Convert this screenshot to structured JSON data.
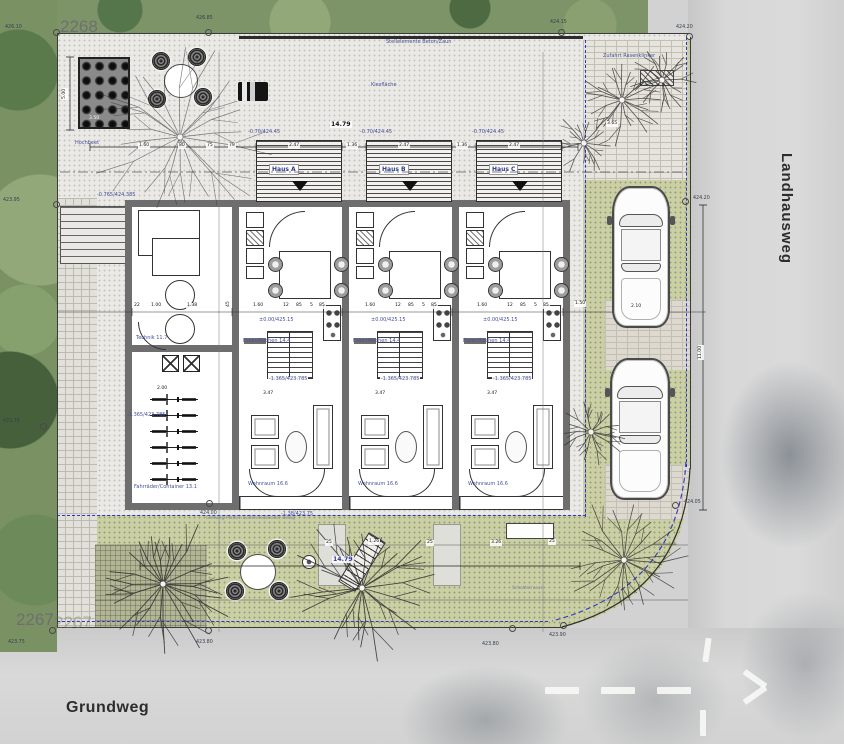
{
  "parcels": {
    "top": "2268",
    "bottom": "2267",
    "bottom_ghost": "2267"
  },
  "streets": {
    "right": "Landhausweg",
    "bottom": "Grundweg"
  },
  "houses": [
    {
      "name": "Haus A"
    },
    {
      "name": "Haus B"
    },
    {
      "name": "Haus C"
    }
  ],
  "annotations": {
    "labels": [
      {
        "t": "Stellelemente Beton/Zaun",
        "x": 386,
        "y": 40
      },
      {
        "t": "Kiesfläche",
        "x": 371,
        "y": 83
      },
      {
        "t": "Hochbeet",
        "x": 75,
        "y": 141
      },
      {
        "t": "Zufahrt Rasenklinker",
        "x": 603,
        "y": 54
      },
      {
        "t": "-0.70/424.45",
        "x": 248,
        "y": 130
      },
      {
        "t": "-0.70/424.45",
        "x": 360,
        "y": 130
      },
      {
        "t": "-0.70/424.45",
        "x": 472,
        "y": 130
      },
      {
        "t": "±0.00/425.15",
        "x": 258,
        "y": 318,
        "tag": 1
      },
      {
        "t": "±0.00/425.15",
        "x": 370,
        "y": 318,
        "tag": 1
      },
      {
        "t": "±0.00/425.15",
        "x": 482,
        "y": 318,
        "tag": 1
      },
      {
        "t": "-1.365/423.785",
        "x": 268,
        "y": 377,
        "tag": 1
      },
      {
        "t": "-1.365/423.785",
        "x": 380,
        "y": 377,
        "tag": 1
      },
      {
        "t": "-1.365/423.785",
        "x": 492,
        "y": 377,
        "tag": 1
      },
      {
        "t": "Essen/Kochen 14.4",
        "x": 243,
        "y": 339
      },
      {
        "t": "Essen/Kochen 14.4",
        "x": 353,
        "y": 339
      },
      {
        "t": "Essen/Kochen 14.4",
        "x": 463,
        "y": 339
      },
      {
        "t": "Wohnraum 16.6",
        "x": 248,
        "y": 482
      },
      {
        "t": "Wohnraum 16.6",
        "x": 358,
        "y": 482
      },
      {
        "t": "Wohnraum 16.6",
        "x": 468,
        "y": 482
      },
      {
        "t": "Technik 11.7",
        "x": 136,
        "y": 336
      },
      {
        "t": "Fahrräder/Container 13.1",
        "x": 133,
        "y": 485,
        "tag": 1
      },
      {
        "t": "-1.365/423.785",
        "x": 127,
        "y": 413
      },
      {
        "t": "-0.765/424.385",
        "x": 97,
        "y": 193
      },
      {
        "t": "-1.38/423.75",
        "x": 281,
        "y": 512
      },
      {
        "t": "Gehweg Platten bodendeckender Belag",
        "x": 206,
        "y": 517,
        "cls": "faint"
      },
      {
        "t": "Schotterrasen",
        "x": 512,
        "y": 587,
        "cls": "faint"
      }
    ],
    "dims": [
      {
        "t": "14.79",
        "x": 330,
        "y": 121,
        "cls": "b"
      },
      {
        "t": "2.47",
        "x": 288,
        "y": 143
      },
      {
        "t": "2.47",
        "x": 398,
        "y": 143
      },
      {
        "t": "2.47",
        "x": 508,
        "y": 143
      },
      {
        "t": "1.36",
        "x": 346,
        "y": 143
      },
      {
        "t": "1.36",
        "x": 456,
        "y": 143
      },
      {
        "t": "1.60",
        "x": 138,
        "y": 143
      },
      {
        "t": "80",
        "x": 178,
        "y": 143
      },
      {
        "t": "75",
        "x": 206,
        "y": 143
      },
      {
        "t": "79",
        "x": 228,
        "y": 143
      },
      {
        "t": "3.50",
        "x": 88,
        "y": 116,
        "cls": "w"
      },
      {
        "t": "5.00",
        "x": 62,
        "y": 100,
        "rot": 1
      },
      {
        "t": "2.00",
        "x": 156,
        "y": 386
      },
      {
        "t": "3.47",
        "x": 262,
        "y": 391
      },
      {
        "t": "3.47",
        "x": 374,
        "y": 391
      },
      {
        "t": "3.47",
        "x": 486,
        "y": 391
      },
      {
        "t": "2.10",
        "x": 630,
        "y": 304
      },
      {
        "t": "1.50",
        "x": 574,
        "y": 301
      },
      {
        "t": "3.65",
        "x": 606,
        "y": 121
      },
      {
        "t": "3.26",
        "x": 490,
        "y": 540
      },
      {
        "t": "14.79",
        "x": 332,
        "y": 556,
        "cls": "b blue"
      },
      {
        "t": "11.00",
        "x": 698,
        "y": 360,
        "rot": 1
      },
      {
        "t": "25",
        "x": 325,
        "y": 540
      },
      {
        "t": "1.26",
        "x": 368,
        "y": 539
      },
      {
        "t": "25",
        "x": 426,
        "y": 540
      },
      {
        "t": "25",
        "x": 548,
        "y": 539
      },
      {
        "t": "22",
        "x": 133,
        "y": 303
      },
      {
        "t": "1.00",
        "x": 150,
        "y": 303
      },
      {
        "t": "1.38",
        "x": 186,
        "y": 303
      },
      {
        "t": "45",
        "x": 226,
        "y": 308,
        "rot": 1
      },
      {
        "t": "1.60",
        "x": 252,
        "y": 303
      },
      {
        "t": "12",
        "x": 282,
        "y": 303
      },
      {
        "t": "85",
        "x": 295,
        "y": 303
      },
      {
        "t": "5",
        "x": 309,
        "y": 303
      },
      {
        "t": "85",
        "x": 318,
        "y": 303
      },
      {
        "t": "1.60",
        "x": 364,
        "y": 303
      },
      {
        "t": "12",
        "x": 394,
        "y": 303
      },
      {
        "t": "85",
        "x": 407,
        "y": 303
      },
      {
        "t": "5",
        "x": 421,
        "y": 303
      },
      {
        "t": "85",
        "x": 430,
        "y": 303
      },
      {
        "t": "1.60",
        "x": 476,
        "y": 303
      },
      {
        "t": "12",
        "x": 506,
        "y": 303
      },
      {
        "t": "85",
        "x": 519,
        "y": 303
      },
      {
        "t": "5",
        "x": 533,
        "y": 303
      },
      {
        "t": "85",
        "x": 542,
        "y": 303
      }
    ],
    "markers": [
      {
        "v": "426.10",
        "cx": 57,
        "cy": 33,
        "tx": 5,
        "ty": 26
      },
      {
        "v": "426.85",
        "cx": 209,
        "cy": 33,
        "tx": 196,
        "ty": 17
      },
      {
        "v": "424.15",
        "cx": 562,
        "cy": 33,
        "tx": 550,
        "ty": 21
      },
      {
        "v": "424.20",
        "cx": 690,
        "cy": 37,
        "tx": 676,
        "ty": 26
      },
      {
        "v": "424.20",
        "cx": 686,
        "cy": 202,
        "tx": 693,
        "ty": 197
      },
      {
        "v": "424.05",
        "cx": 676,
        "cy": 506,
        "tx": 684,
        "ty": 501
      },
      {
        "v": "423.90",
        "cx": 564,
        "cy": 626,
        "tx": 549,
        "ty": 634
      },
      {
        "v": "423.80",
        "cx": 513,
        "cy": 629,
        "tx": 482,
        "ty": 643
      },
      {
        "v": "423.80",
        "cx": 209,
        "cy": 631,
        "tx": 196,
        "ty": 641
      },
      {
        "v": "423.75",
        "cx": 53,
        "cy": 631,
        "tx": 8,
        "ty": 641
      },
      {
        "v": "423.75",
        "cx": 44,
        "cy": 427,
        "tx": 3,
        "ty": 420
      },
      {
        "v": "423.95",
        "cx": 57,
        "cy": 205,
        "tx": 3,
        "ty": 199
      },
      {
        "v": "424.00",
        "cx": 210,
        "cy": 504,
        "tx": 200,
        "ty": 512
      }
    ]
  },
  "colors": {
    "accent_blue": "#44509a",
    "boundary_blue": "#2b35cc",
    "wall": "#6e6e6e",
    "road": "#d2d2d2",
    "grass": "#7d9468",
    "olive": "#cbcfa5",
    "kies": "#eae9e5"
  }
}
